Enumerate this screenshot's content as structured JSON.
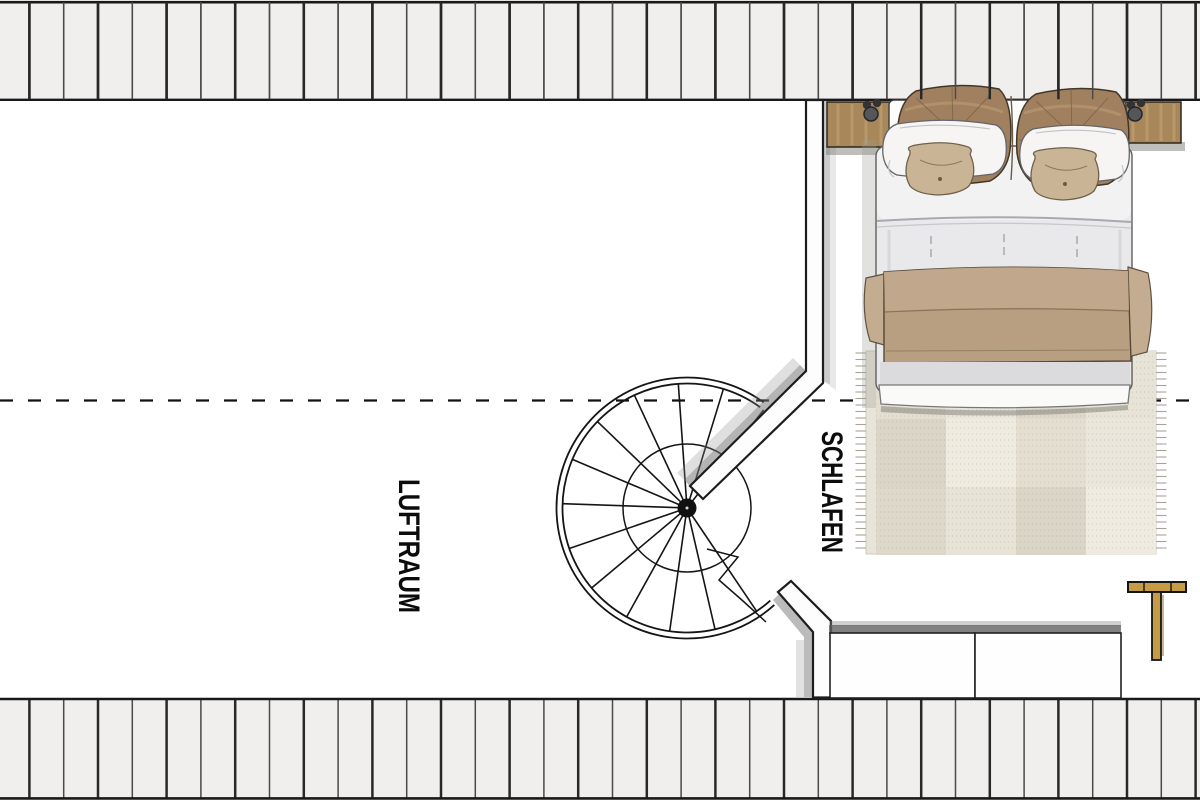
{
  "plan": {
    "type": "floor-plan-top-view",
    "level": "attic / gallery level",
    "rooms": {
      "schlafen": {
        "label": "SCHLAFEN"
      },
      "luftraum": {
        "label": "LUFTRAUM"
      }
    },
    "elements": [
      "top-roof-plank-band",
      "bottom-roof-plank-band",
      "section-dashed-line",
      "spiral-staircase",
      "bedroom-partition-wall-upper",
      "bedroom-partition-wall-lower",
      "double-bed",
      "nightstand-left",
      "nightstand-right",
      "rug",
      "cabinet-left",
      "cabinet-right",
      "clothes-rack"
    ]
  },
  "colors": {
    "plank_fill": "#f0efee",
    "plank_line_dark": "#282828",
    "plank_line_light": "#4a4a4a",
    "outline": "#1d1d1d",
    "wall_fill": "#fdfdfd",
    "shadow_gray": "#8b8b8b",
    "wood": "#a8875a",
    "wood_streak": "#c3a473",
    "rack_wood": "#c59b45",
    "pillow_brown": "#a18060",
    "pillow_white": "#f6f5f3",
    "cushion_tan": "#c9b596",
    "blanket": "#b89f82",
    "blanket_flap": "#c3ac8f",
    "duvet": "#e9e9eb",
    "duvet_sheet": "#f2f2f3",
    "bed_foot_band": "#dbdbde",
    "rug": "#e8e4d9",
    "cabinet_fill": "#fefefe",
    "dash_line": "#101010"
  }
}
